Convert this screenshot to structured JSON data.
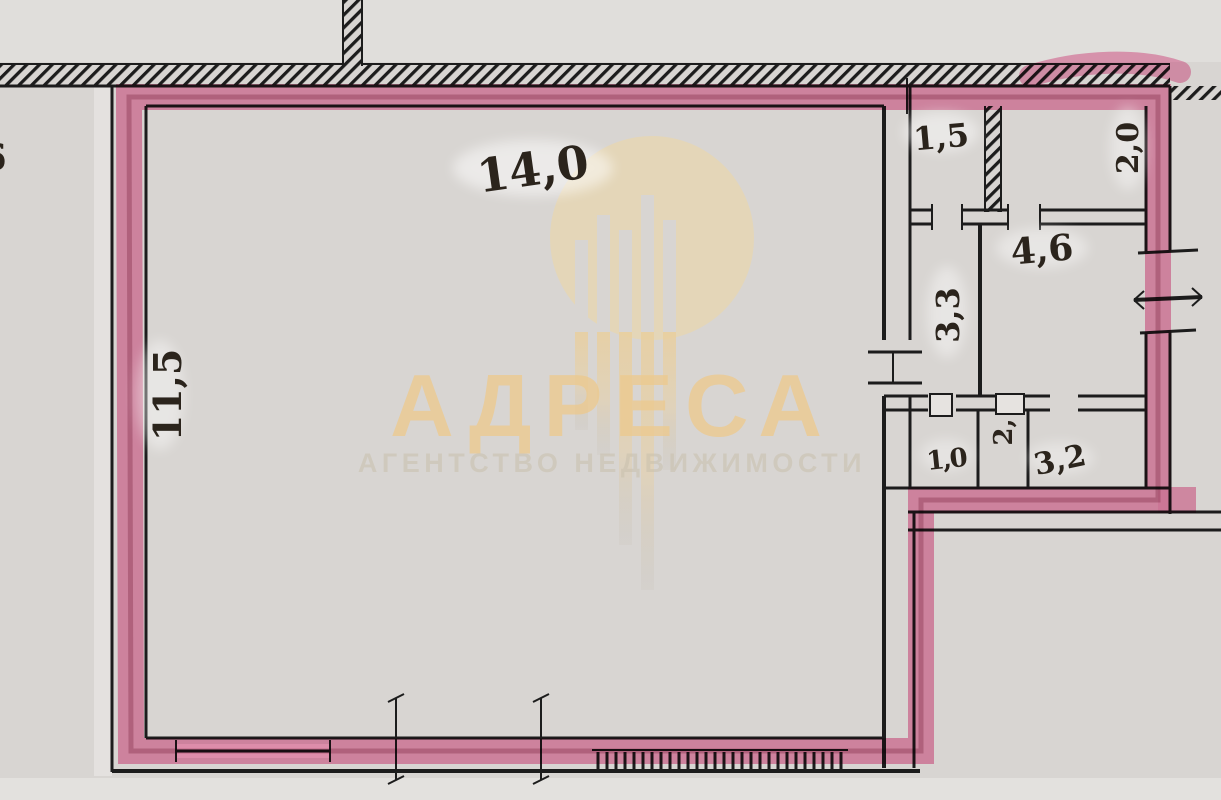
{
  "floor_plan": {
    "paper_color": "#d8d5d2",
    "wall_color": "#1c1c1c",
    "highlight_color": "#f08bb4",
    "highlight_core_color": "#8e2c4a",
    "rooms": [
      {
        "name": "main-room",
        "area_label": "14,0",
        "orientation": "horizontal"
      },
      {
        "name": "main-room-side-dimension",
        "area_label": "11,5",
        "orientation": "vertical"
      },
      {
        "name": "top-right-room-left",
        "area_label": "1,5",
        "orientation": "horizontal"
      },
      {
        "name": "top-right-room-right",
        "area_label": "2,0",
        "orientation": "vertical"
      },
      {
        "name": "middle-right-room",
        "area_label": "4,6",
        "orientation": "horizontal"
      },
      {
        "name": "middle-corridor",
        "area_label": "3,3",
        "orientation": "vertical"
      },
      {
        "name": "bottom-right-room-small",
        "area_label": "1,0",
        "orientation": "horizontal"
      },
      {
        "name": "bottom-right-room-middle",
        "area_label": "2,",
        "orientation": "vertical"
      },
      {
        "name": "bottom-right-room-large",
        "area_label": "3,2",
        "orientation": "horizontal"
      },
      {
        "name": "left-edge-room-fragment",
        "area_label": "6",
        "orientation": "horizontal"
      }
    ]
  },
  "watermark": {
    "brand": "АДРЕСА",
    "tagline": "АГЕНТСТВО НЕДВИЖИМОСТИ",
    "brand_color": "#ecca90",
    "logo": "city-buildings-circle-icon"
  }
}
